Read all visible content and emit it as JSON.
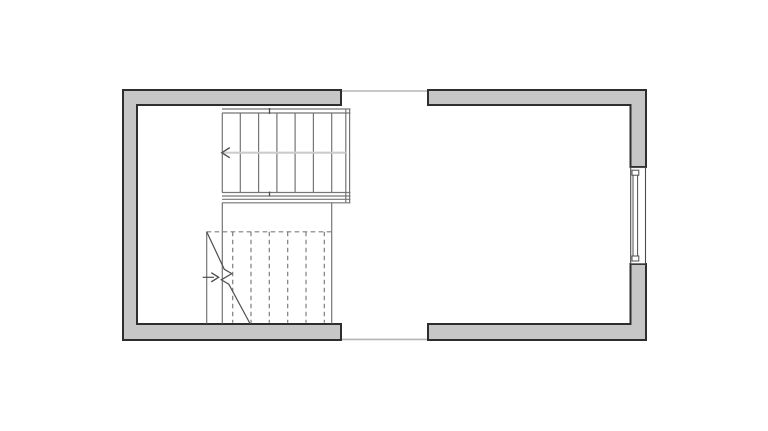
{
  "colors": {
    "background": "#ffffff",
    "wall_fill": "#c6c6c6",
    "wall_outline": "#2e2e2e",
    "line": "#757575",
    "line_dark": "#4f4f4f",
    "center_line": "#cccccc",
    "dashed": "#7e7e7e",
    "opening_line": "#b5b5b5",
    "window_outline": "#4c4c4c",
    "window_fill": "#ffffff"
  },
  "plan": {
    "canvas": {
      "w": 768,
      "h": 431
    },
    "walls": [
      {
        "name": "wall-left-section",
        "points": [
          [
            341,
            90
          ],
          [
            123,
            90
          ],
          [
            123,
            340
          ],
          [
            341,
            340
          ],
          [
            341,
            324
          ],
          [
            137,
            324
          ],
          [
            137,
            105
          ],
          [
            341,
            105
          ]
        ]
      },
      {
        "name": "wall-top-right-section",
        "points": [
          [
            428,
            90
          ],
          [
            646,
            90
          ],
          [
            646,
            167
          ],
          [
            630.5,
            167
          ],
          [
            630.5,
            105
          ],
          [
            428,
            105
          ]
        ]
      },
      {
        "name": "wall-bottom-right-section",
        "points": [
          [
            428,
            324
          ],
          [
            630.5,
            324
          ],
          [
            630.5,
            264
          ],
          [
            646,
            264
          ],
          [
            646,
            340
          ],
          [
            428,
            340
          ]
        ]
      }
    ],
    "opening_lines": [
      {
        "name": "top-opening-line",
        "x1": 341,
        "y1": 91,
        "x2": 428,
        "y2": 91
      },
      {
        "name": "bottom-opening-line",
        "x1": 341,
        "y1": 339.4,
        "x2": 428,
        "y2": 339.4
      }
    ],
    "window": {
      "frame": {
        "x": 630.7,
        "y": 167.5,
        "w": 14.8,
        "h": 96.3
      },
      "glazing": {
        "x": 633,
        "y": 171.5,
        "w": 4.6,
        "h": 88.8
      },
      "caps": [
        {
          "x": 632,
          "y": 170.2,
          "w": 6.8,
          "h": 5
        },
        {
          "x": 632,
          "y": 256,
          "w": 6.8,
          "h": 5
        }
      ]
    },
    "stair_upper": {
      "rails": [
        {
          "x1": 222,
          "y1": 109,
          "x2": 350.5,
          "y2": 109
        },
        {
          "x1": 222,
          "y1": 113,
          "x2": 350.5,
          "y2": 113
        },
        {
          "x1": 222,
          "y1": 192.5,
          "x2": 350.5,
          "y2": 192.5
        },
        {
          "x1": 222,
          "y1": 196,
          "x2": 350.5,
          "y2": 196
        },
        {
          "x1": 222,
          "y1": 199.3,
          "x2": 350.5,
          "y2": 199.3
        },
        {
          "x1": 222,
          "y1": 202.8,
          "x2": 350.5,
          "y2": 202.8
        }
      ],
      "right_edge": [
        {
          "x1": 345.8,
          "y1": 109,
          "x2": 345.8,
          "y2": 202.8
        },
        {
          "x1": 349.6,
          "y1": 109,
          "x2": 349.6,
          "y2": 202.8
        }
      ],
      "ticks": [
        {
          "x1": 269.5,
          "y1": 108,
          "x2": 269.5,
          "y2": 114
        },
        {
          "x1": 269.5,
          "y1": 191.5,
          "x2": 269.5,
          "y2": 196.5
        }
      ],
      "treads": {
        "x": [
          222.3,
          240.3,
          258.6,
          276.9,
          295.1,
          313.4,
          331.7
        ],
        "y1": 113,
        "y2": 192.5
      },
      "center_line": {
        "x1": 222,
        "y1": 152.7,
        "x2": 345.8,
        "y2": 152.7
      },
      "arrow": {
        "points": [
          [
            229.8,
            147.6
          ],
          [
            221.8,
            152.7
          ],
          [
            229.8,
            157.8
          ]
        ]
      }
    },
    "stairwell_edges": [
      {
        "x1": 222.3,
        "y1": 202.8,
        "x2": 222.3,
        "y2": 323.5
      },
      {
        "x1": 331.7,
        "y1": 202.8,
        "x2": 331.7,
        "y2": 323.5
      }
    ],
    "stair_lower": {
      "top_edge_dashed": {
        "x1": 206.7,
        "y1": 231.8,
        "x2": 331.7,
        "y2": 231.8
      },
      "treads_dashed": {
        "x": [
          232.7,
          251,
          269.3,
          287.7,
          306,
          324.3
        ],
        "y1": 231.8,
        "y2": 322.8
      },
      "side_line": {
        "x1": 206.7,
        "y1": 231.8,
        "x2": 206.7,
        "y2": 323.5
      },
      "break_line_points": [
        [
          206.7,
          231.8
        ],
        [
          224.3,
          269.3
        ],
        [
          231.8,
          273.6
        ],
        [
          221.3,
          279.8
        ],
        [
          228.8,
          284.2
        ],
        [
          250,
          323.5
        ]
      ],
      "arrow_line": {
        "x1": 202.7,
        "y1": 277.3,
        "x2": 214,
        "y2": 277.3
      },
      "arrow": {
        "points": [
          [
            211.3,
            272.7
          ],
          [
            218.6,
            277.3
          ],
          [
            211.3,
            281.9
          ]
        ]
      }
    }
  }
}
